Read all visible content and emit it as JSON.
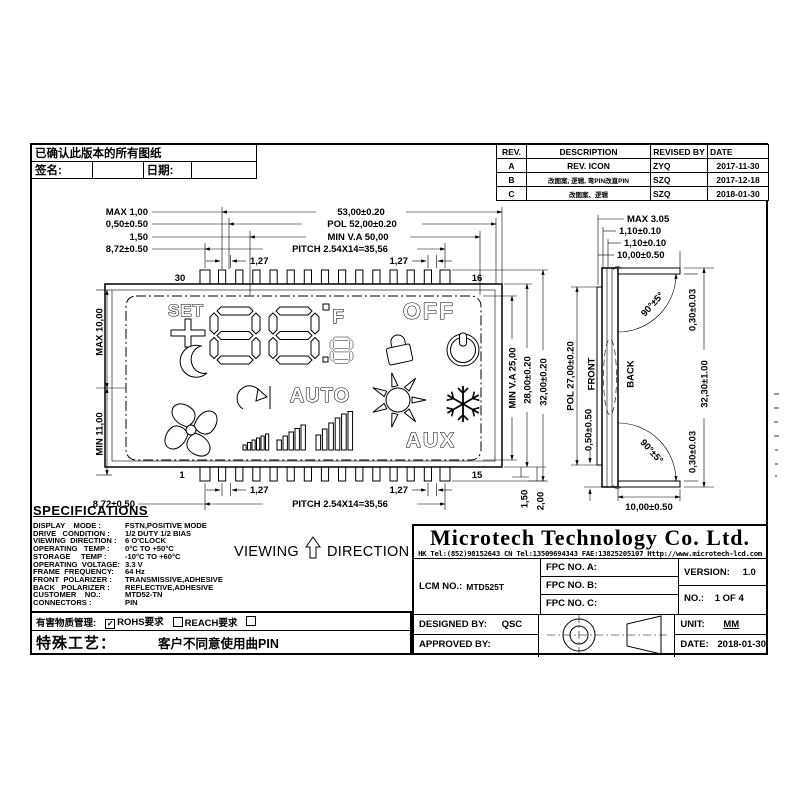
{
  "confirm_table": {
    "title": "已确认此版本的所有图纸",
    "sign_label": "签名:",
    "date_label": "日期:"
  },
  "revision_table": {
    "headers": {
      "rev": "REV.",
      "description": "DESCRIPTION",
      "revised_by": "REVISED BY",
      "date": "DATE"
    },
    "rows": [
      {
        "rev": "A",
        "description": "REV. ICON",
        "by": "ZYQ",
        "date": "2017-11-30"
      },
      {
        "rev": "B",
        "description": "改图案, 逻辑, 弯PIN改直PIN",
        "by": "SZQ",
        "date": "2017-12-18"
      },
      {
        "rev": "C",
        "description": "改图案、逻辑",
        "by": "SZQ",
        "date": "2018-01-30"
      }
    ]
  },
  "front_view": {
    "pins": {
      "top_left": "30",
      "top_right": "16",
      "bottom_left": "1",
      "bottom_right": "15"
    },
    "dims": {
      "total_width": "53,00±0.20",
      "pol_width": "POL 52,00±0.20",
      "va_width": "MIN V.A 50,00",
      "pitch": "PITCH 2.54X14=35,56",
      "gap": "1,27",
      "max_top": "MAX 1,00",
      "glass_offset": "0,50±0.50",
      "va_offset": "1,50",
      "pin_len": "8,72±0.50",
      "left_upper": "MAX 10,00",
      "left_lower": "MIN 11,00",
      "right_va": "MIN V.A 25,00",
      "right_glass": "28,00±0.20",
      "right_total": "32,00±0.20",
      "pin_150": "1,50",
      "pin_200": "2,00"
    },
    "lcd": {
      "set": "SET",
      "off": "OFF",
      "auto": "AUTO",
      "aux": "AUX",
      "deg_f": "F"
    }
  },
  "side_view": {
    "max_thickness": "MAX 3.05",
    "glass_110": "1,10±0.10",
    "flange": "10,00±0.50",
    "angle": "90°±5°",
    "front": "FRONT",
    "back": "BACK",
    "pol": "POL 27,00±0.20",
    "pol_offset": "0,50±0.50",
    "edge_030": "0,30±0.03",
    "total_height": "32,30±1.00"
  },
  "viewing_direction": {
    "word1": "VIEWING",
    "word2": "DIRECTION"
  },
  "specifications": {
    "title": "SPECIFICATIONS",
    "rows": [
      {
        "l": "DISPLAY    MODE :",
        "v": "FSTN,POSITIVE MODE"
      },
      {
        "l": "DRIVE   CONDITION :",
        "v": "1/2 DUTY 1/2 BIAS"
      },
      {
        "l": "VIEWING  DIRECTION :",
        "v": "6 O'CLOCK"
      },
      {
        "l": "OPERATING   TEMP :",
        "v": "0°C TO +50°C"
      },
      {
        "l": "STORAGE     TEMP :",
        "v": "-10°C TO +60°C"
      },
      {
        "l": "OPERATING  VOLTAGE:",
        "v": "3.3 V"
      },
      {
        "l": "FRAME  FREQUENCY:",
        "v": "64 Hz"
      },
      {
        "l": "FRONT  POLARIZER :",
        "v": "TRANSMISSIVE,ADHESIVE"
      },
      {
        "l": "BACK   POLARIZER :",
        "v": "REFLECTIVE,ADHESIVE"
      },
      {
        "l": "CUSTOMER    NO.:",
        "v": "MTD52-TN"
      },
      {
        "l": "CONNECTORS :",
        "v": "PIN"
      }
    ],
    "hazard": {
      "label": "有害物质管理:",
      "items": [
        {
          "mark": "✓",
          "text": "ROHS要求"
        },
        {
          "mark": "",
          "text": "REACH要求"
        },
        {
          "mark": "",
          "text": "无卤要求"
        }
      ]
    },
    "special": {
      "label": "特殊工艺：",
      "value": "客户不同意使用曲PIN"
    }
  },
  "title_block": {
    "company": "Microtech Technology Co. Ltd.",
    "contact": "HK Tel:(852)98152643  CN Tel:13509694343 FAE:13825205107 Http://www.microtech-lcd.com",
    "lcm_label": "LCM NO.:",
    "lcm_value": "MTD525T",
    "fpc_a": "FPC NO. A:",
    "fpc_b": "FPC NO. B:",
    "fpc_c": "FPC NO. C:",
    "version_label": "VERSION:",
    "version_value": "1.0",
    "no_label": "NO.:",
    "no_value": "1  OF  4",
    "designed_label": "DESIGNED BY:",
    "designed_value": "QSC",
    "approved_label": "APPROVED BY:",
    "unit_label": "UNIT:",
    "unit_value": "MM",
    "date_label": "DATE:",
    "date_value": "2018-01-30"
  }
}
